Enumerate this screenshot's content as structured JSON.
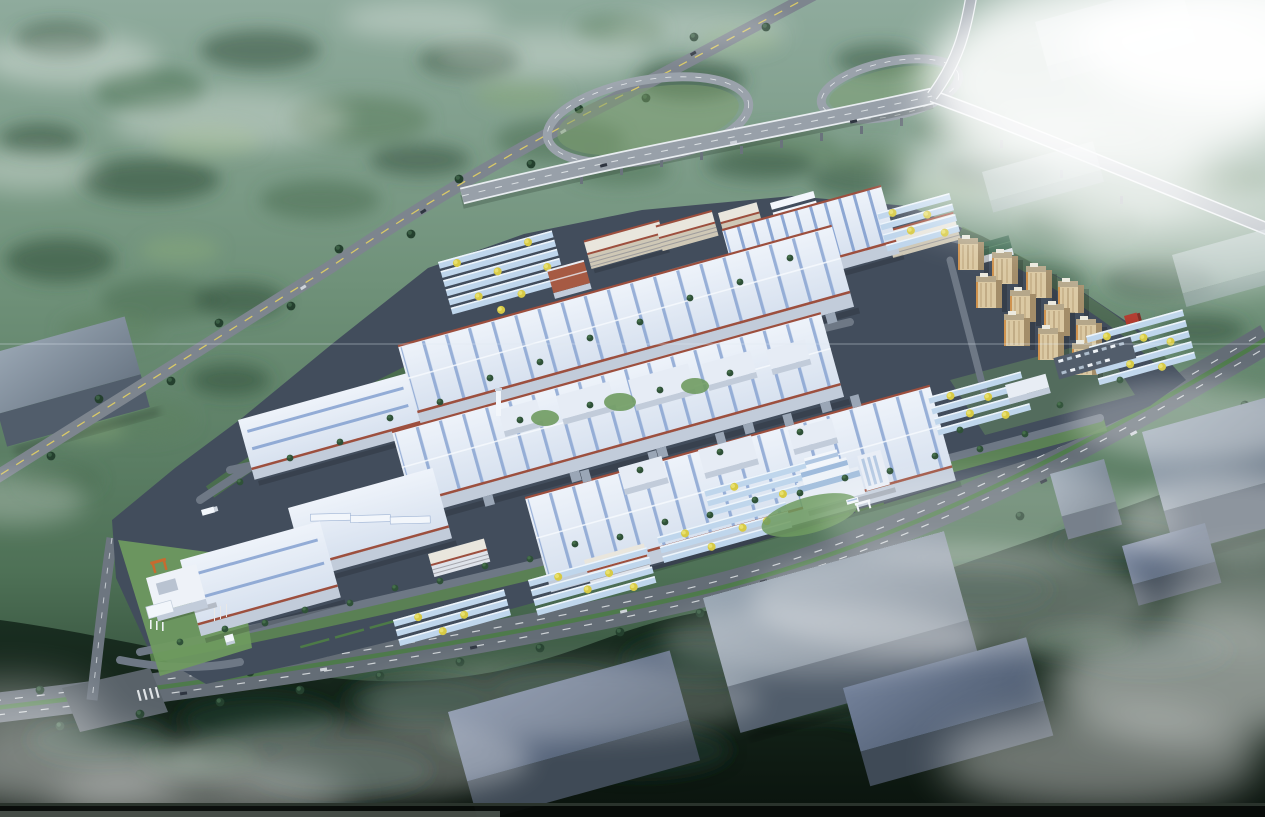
{
  "scene": {
    "type": "aerial-architectural-rendering",
    "subject": "bird's-eye master-plan rendering of a large industrial park campus surrounded by misty forest",
    "regions": [
      "highway interchange with two loop ramps (top)",
      "straight arterial road with yellow center line (upper left)",
      "industrial campus with white factory halls, blue skylight stripes and red-brown roof trim",
      "multi-story dormitory blocks along north edge",
      "solar parking canopy rows with yellow trees",
      "cluster of beige residential towers (east)",
      "terraced white office building near south entrance",
      "perimeter boulevard with green median (south)",
      "gray warehouse blocks outside the campus",
      "dense dark forest belt and white mist patches"
    ]
  },
  "inventory": {
    "factory_halls": 7,
    "dormitory_blocks": 6,
    "residential_towers": 11,
    "parking_canopy_groups": 8,
    "warehouse_blocks": 7,
    "highway_loop_ramps": 2,
    "visible_text": ""
  },
  "palette": {
    "forest_light": "#8fab9d",
    "forest_mid": "#5d8160",
    "forest_deep": "#33523e",
    "forest_dark": "#16281c",
    "meadow": "#8aaa7c",
    "mist": "#ffffff",
    "asphalt_campus": "#424d5c",
    "campus_drive": "#6e7885",
    "road_highway": "#98a0a9",
    "road_arterial": "#7d858e",
    "road_boulevard": "#646d76",
    "road_connector": "#6d7680",
    "lane_white": "#e8ecef",
    "lane_yellow": "#d9c967",
    "median_green": "#4e7a4b",
    "roof_white_hi": "#eef3fa",
    "roof_white_lo": "#d7e1ef",
    "roof_stripe": "#7d9bcd",
    "roof_trim": "#9d4f3e",
    "wall_light": "#c2ccda",
    "wall_shade": "#9aa6b6",
    "canopy": "#bfd6ec",
    "canopy_edge": "#eef5fb",
    "dorm_wall": "#cfc8b6",
    "dorm_roof": "#e9e6dd",
    "tower_face": "#dbc9a3",
    "tower_side": "#a38d69",
    "tower_roof": "#b5a78a",
    "tower_accent": "#cd8a41",
    "office_glass": "#9fbbdc",
    "green_roof": "#3c6950",
    "lawn": "#6f9b60",
    "hedge": "#4d7a47",
    "tree_dark": "#2f5138",
    "tree_lite": "#456f4a",
    "tree_yellow": "#d7ca45",
    "box_roof_hi": "#9aa7b4",
    "box_roof_lo": "#6b7886",
    "box_wall": "#515d6b",
    "box_wall_dark": "#3f4a56",
    "red_accent": "#b23a2e",
    "orange_gate": "#c76b2f",
    "scan_black": "#070b08"
  }
}
